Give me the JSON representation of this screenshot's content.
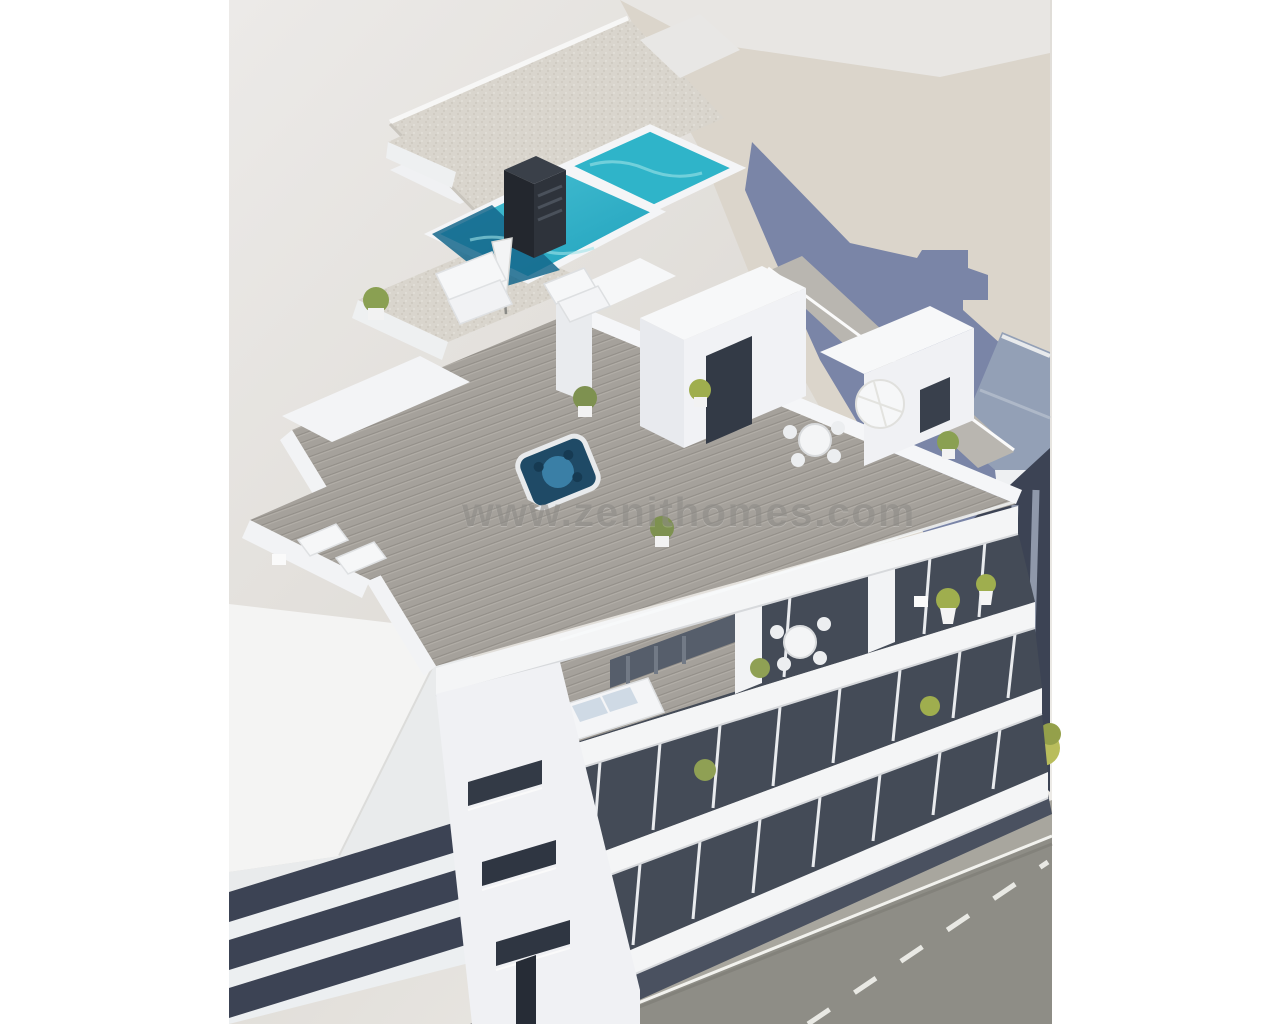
{
  "scene": {
    "type": "3d-architectural-render",
    "subject": "Aerial 3D render of a modern white apartment building with rooftop swimming pool, jacuzzi, sun terraces, planted balconies, neighbouring buildings and a street with trees and lane markings",
    "watermark": "www.zenithomes.com"
  },
  "features": [
    "L-shaped turquoise rooftop pool",
    "dark chimney block beside pool",
    "gravel-textured roof slabs",
    "wooden roof deck with sun loungers and parasols",
    "jacuzzi hot tub",
    "penthouse terrace with white sofa set",
    "balcony with round dining table and chairs",
    "potted green plants",
    "white parapet bands over dark recessed floors",
    "street with dashed lane marking and sidewalk trees",
    "building shadow cast on neighbouring ground"
  ],
  "palette": {
    "canvas_white": "#ffffff",
    "backdrop_gray_light": "#ecebe9",
    "backdrop_gray_dark": "#d9d6d1",
    "ground_beige": "#dbd5cb",
    "cast_shadow_slate": "#61719e",
    "pool_turquoise": "#2fb4c9",
    "pool_deep_blue": "#15678c",
    "pool_ripple": "#9fe2e8",
    "jacuzzi_blue": "#1f4a66",
    "gravel_roof": "#d9d5cd",
    "deck_gray": "#a5a19b",
    "facade_white": "#f3f4f6",
    "facade_shadow": "#dfe1e5",
    "window_recess_dark": "#444b57",
    "glass_dark": "#333a46",
    "street_asphalt": "#8e8d86",
    "sidewalk_gray": "#a8a69e",
    "lane_marking": "#e9e9e4",
    "tree_yellow_green": "#b9bd5c",
    "tree_green_dark": "#94a04a",
    "neighbor_floor_dark": "#3c4354",
    "watermark_gray": "#8d8b87"
  }
}
